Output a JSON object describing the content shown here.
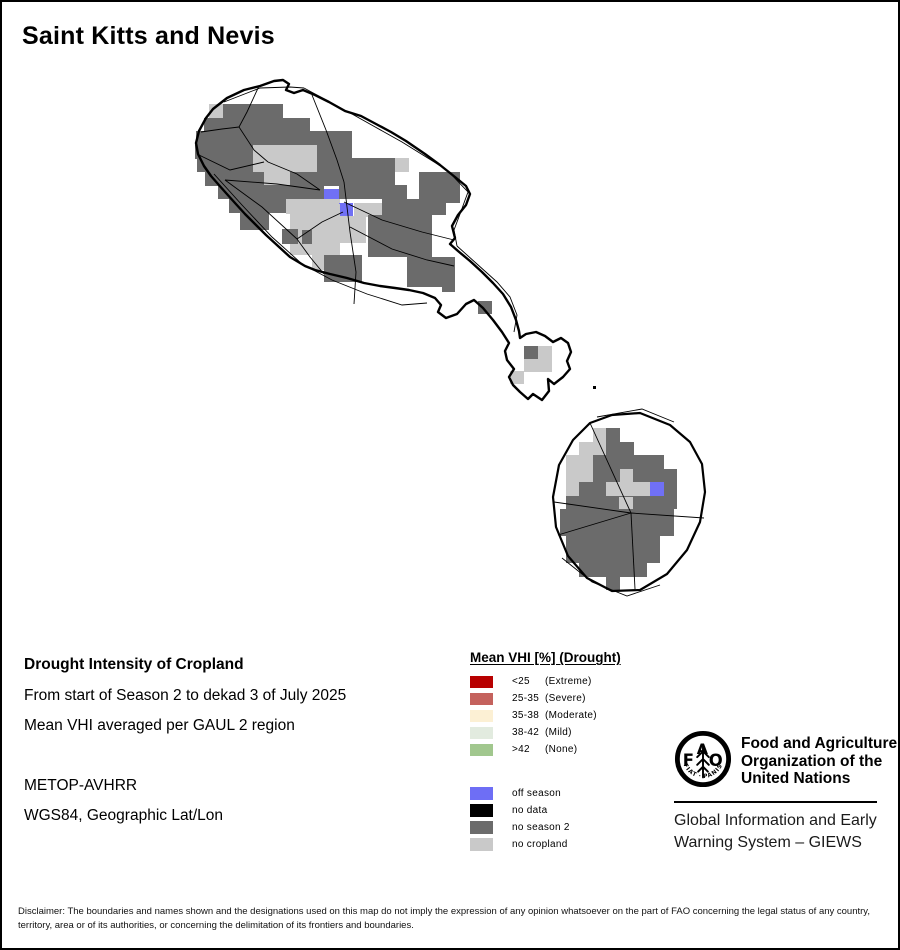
{
  "title": "Saint Kitts and Nevis",
  "info": {
    "heading": "Drought Intensity of Cropland",
    "period_line": "From start of Season 2 to dekad 3 of July 2025",
    "method_line": "Mean VHI averaged per GAUL 2 region",
    "sensor_line": "METOP-AVHRR",
    "projection_line": "WGS84, Geographic Lat/Lon"
  },
  "legend": {
    "title": "Mean VHI [%] (Drought)",
    "drought_classes": [
      {
        "range": "<25",
        "label": "(Extreme)",
        "color": "#B80000"
      },
      {
        "range": "25-35",
        "label": "(Severe)",
        "color": "#C4625D"
      },
      {
        "range": "35-38",
        "label": "(Moderate)",
        "color": "#FCF0D4"
      },
      {
        "range": "38-42",
        "label": "(Mild)",
        "color": "#E2EBDF"
      },
      {
        "range": ">42",
        "label": "(None)",
        "color": "#A1C78E"
      }
    ],
    "season_classes": [
      {
        "label": "off season",
        "color": "#6E6EF5"
      },
      {
        "label": "no data",
        "color": "#000000"
      },
      {
        "label": "no season 2",
        "color": "#6B6B6B"
      },
      {
        "label": "no cropland",
        "color": "#C9C9C9"
      }
    ]
  },
  "fao": {
    "logo_letters": "FAO",
    "logo_motto": "FIAT · PANIS",
    "org_lines": [
      "Food and Agriculture",
      "Organization of the",
      "United Nations"
    ],
    "giews_lines": [
      "Global Information and Early",
      "Warning System – GIEWS"
    ]
  },
  "disclaimer": "Disclaimer: The boundaries and names shown and the designations used on this map do not imply the expression of any opinion whatsoever on the part of FAO concerning the legal status of any country, territory, area or of its authorities, or concerning the delimitation of its frontiers and boundaries.",
  "map": {
    "colors": {
      "d": "#6B6B6B",
      "l": "#C9C9C9",
      "b": "#7070F5",
      "k": "#000000"
    },
    "color_meaning": {
      "d": "no season 2",
      "l": "no cropland",
      "b": "off season",
      "k": "no data"
    },
    "cells": [
      [
        "l",
        207,
        102,
        14,
        14
      ],
      [
        "d",
        221,
        102,
        60,
        14
      ],
      [
        "d",
        202,
        116,
        106,
        14
      ],
      [
        "d",
        194,
        129,
        156,
        14
      ],
      [
        "d",
        193,
        143,
        58,
        14
      ],
      [
        "l",
        251,
        143,
        64,
        14
      ],
      [
        "d",
        315,
        143,
        35,
        14
      ],
      [
        "d",
        195,
        156,
        56,
        14
      ],
      [
        "l",
        251,
        156,
        64,
        14
      ],
      [
        "d",
        315,
        156,
        78,
        14
      ],
      [
        "l",
        393,
        156,
        14,
        14
      ],
      [
        "d",
        203,
        170,
        59,
        14
      ],
      [
        "l",
        262,
        170,
        26,
        14
      ],
      [
        "d",
        288,
        170,
        105,
        14
      ],
      [
        "d",
        417,
        170,
        41,
        14
      ],
      [
        "d",
        216,
        183,
        106,
        14
      ],
      [
        "d",
        337,
        183,
        68,
        14
      ],
      [
        "d",
        417,
        183,
        41,
        18
      ],
      [
        "b",
        322,
        187,
        15,
        14
      ],
      [
        "d",
        227,
        197,
        57,
        14
      ],
      [
        "l",
        284,
        197,
        54,
        15
      ],
      [
        "l",
        352,
        201,
        28,
        14
      ],
      [
        "d",
        380,
        197,
        64,
        16
      ],
      [
        "b",
        337,
        201,
        14,
        13
      ],
      [
        "d",
        238,
        203,
        29,
        25
      ],
      [
        "l",
        288,
        202,
        50,
        51
      ],
      [
        "l",
        338,
        214,
        26,
        27
      ],
      [
        "d",
        366,
        213,
        64,
        42
      ],
      [
        "d",
        280,
        227,
        16,
        15
      ],
      [
        "d",
        300,
        228,
        10,
        14
      ],
      [
        "l",
        310,
        247,
        28,
        21
      ],
      [
        "d",
        322,
        253,
        38,
        27
      ],
      [
        "d",
        405,
        255,
        48,
        30
      ],
      [
        "d",
        440,
        277,
        13,
        13
      ],
      [
        "d",
        476,
        299,
        14,
        13
      ],
      [
        "d",
        522,
        344,
        14,
        13
      ],
      [
        "l",
        536,
        344,
        14,
        26
      ],
      [
        "l",
        522,
        357,
        14,
        13
      ],
      [
        "l",
        508,
        369,
        14,
        13
      ],
      [
        "k",
        591,
        384,
        3,
        3
      ],
      [
        "l",
        591,
        426,
        13,
        14
      ],
      [
        "d",
        604,
        426,
        14,
        14
      ],
      [
        "l",
        577,
        440,
        27,
        13
      ],
      [
        "d",
        604,
        440,
        28,
        13
      ],
      [
        "l",
        564,
        453,
        27,
        14
      ],
      [
        "d",
        591,
        453,
        71,
        14
      ],
      [
        "l",
        564,
        467,
        27,
        13
      ],
      [
        "d",
        591,
        467,
        27,
        13
      ],
      [
        "l",
        618,
        467,
        13,
        13
      ],
      [
        "d",
        631,
        467,
        44,
        13
      ],
      [
        "l",
        564,
        480,
        13,
        14
      ],
      [
        "d",
        577,
        480,
        27,
        14
      ],
      [
        "l",
        604,
        480,
        44,
        14
      ],
      [
        "b",
        648,
        480,
        14,
        14
      ],
      [
        "d",
        662,
        480,
        13,
        14
      ],
      [
        "d",
        564,
        494,
        111,
        13
      ],
      [
        "l",
        617,
        495,
        14,
        13
      ],
      [
        "d",
        558,
        507,
        114,
        14
      ],
      [
        "d",
        558,
        521,
        114,
        13
      ],
      [
        "d",
        564,
        534,
        94,
        14
      ],
      [
        "d",
        564,
        548,
        94,
        13
      ],
      [
        "d",
        577,
        561,
        68,
        14
      ],
      [
        "d",
        604,
        575,
        14,
        13
      ]
    ],
    "coastlines": [
      {
        "name": "saint-kitts-coast",
        "width": 2.4,
        "closed": true,
        "points": [
          [
            211,
            107
          ],
          [
            225,
            96
          ],
          [
            242,
            88
          ],
          [
            258,
            84
          ],
          [
            272,
            79
          ],
          [
            281,
            78
          ],
          [
            287,
            82
          ],
          [
            284,
            88
          ],
          [
            292,
            91
          ],
          [
            301,
            88
          ],
          [
            313,
            93
          ],
          [
            327,
            100
          ],
          [
            343,
            109
          ],
          [
            359,
            114
          ],
          [
            374,
            122
          ],
          [
            389,
            130
          ],
          [
            404,
            139
          ],
          [
            423,
            152
          ],
          [
            438,
            163
          ],
          [
            453,
            175
          ],
          [
            464,
            184
          ],
          [
            468,
            192
          ],
          [
            464,
            203
          ],
          [
            456,
            213
          ],
          [
            450,
            224
          ],
          [
            453,
            236
          ],
          [
            448,
            242
          ],
          [
            456,
            249
          ],
          [
            468,
            259
          ],
          [
            480,
            270
          ],
          [
            491,
            281
          ],
          [
            501,
            292
          ],
          [
            509,
            305
          ],
          [
            514,
            318
          ],
          [
            517,
            329
          ],
          [
            518,
            336
          ],
          [
            524,
            332
          ],
          [
            534,
            330
          ],
          [
            543,
            334
          ],
          [
            551,
            340
          ],
          [
            559,
            336
          ],
          [
            566,
            341
          ],
          [
            569,
            350
          ],
          [
            565,
            359
          ],
          [
            568,
            367
          ],
          [
            561,
            375
          ],
          [
            552,
            382
          ],
          [
            546,
            377
          ],
          [
            547,
            389
          ],
          [
            540,
            398
          ],
          [
            531,
            392
          ],
          [
            526,
            397
          ],
          [
            518,
            390
          ],
          [
            511,
            383
          ],
          [
            507,
            375
          ],
          [
            512,
            367
          ],
          [
            505,
            358
          ],
          [
            503,
            349
          ],
          [
            507,
            341
          ],
          [
            500,
            330
          ],
          [
            491,
            318
          ],
          [
            481,
            306
          ],
          [
            472,
            298
          ],
          [
            464,
            302
          ],
          [
            455,
            312
          ],
          [
            444,
            316
          ],
          [
            436,
            310
          ],
          [
            439,
            303
          ],
          [
            433,
            296
          ],
          [
            421,
            291
          ],
          [
            407,
            288
          ],
          [
            393,
            286
          ],
          [
            378,
            284
          ],
          [
            362,
            281
          ],
          [
            345,
            276
          ],
          [
            328,
            272
          ],
          [
            313,
            268
          ],
          [
            303,
            264
          ],
          [
            288,
            255
          ],
          [
            276,
            244
          ],
          [
            264,
            233
          ],
          [
            253,
            222
          ],
          [
            243,
            212
          ],
          [
            233,
            201
          ],
          [
            224,
            191
          ],
          [
            216,
            182
          ],
          [
            209,
            174
          ],
          [
            202,
            164
          ],
          [
            196,
            152
          ],
          [
            194,
            141
          ],
          [
            197,
            129
          ],
          [
            204,
            116
          ]
        ]
      },
      {
        "name": "nevis-coast",
        "width": 2.2,
        "closed": true,
        "points": [
          [
            588,
            421
          ],
          [
            610,
            413
          ],
          [
            638,
            411
          ],
          [
            668,
            423
          ],
          [
            688,
            440
          ],
          [
            700,
            462
          ],
          [
            703,
            490
          ],
          [
            698,
            520
          ],
          [
            685,
            548
          ],
          [
            665,
            572
          ],
          [
            638,
            588
          ],
          [
            610,
            589
          ],
          [
            585,
            576
          ],
          [
            566,
            554
          ],
          [
            554,
            525
          ],
          [
            551,
            495
          ],
          [
            557,
            463
          ],
          [
            571,
            438
          ]
        ]
      }
    ],
    "boundaries": [
      [
        [
          257,
          84
        ],
        [
          245,
          110
        ],
        [
          237,
          125
        ],
        [
          252,
          148
        ],
        [
          266,
          160
        ]
      ],
      [
        [
          199,
          130
        ],
        [
          220,
          127
        ],
        [
          237,
          125
        ]
      ],
      [
        [
          197,
          153
        ],
        [
          228,
          168
        ],
        [
          262,
          160
        ]
      ],
      [
        [
          266,
          160
        ],
        [
          295,
          172
        ],
        [
          318,
          188
        ]
      ],
      [
        [
          318,
          188
        ],
        [
          275,
          182
        ],
        [
          223,
          178
        ]
      ],
      [
        [
          223,
          178
        ],
        [
          260,
          205
        ],
        [
          295,
          237
        ]
      ],
      [
        [
          295,
          237
        ],
        [
          320,
          220
        ],
        [
          341,
          210
        ]
      ],
      [
        [
          295,
          237
        ],
        [
          308,
          255
        ],
        [
          322,
          272
        ]
      ],
      [
        [
          342,
          180
        ],
        [
          348,
          230
        ],
        [
          354,
          270
        ],
        [
          352,
          302
        ]
      ],
      [
        [
          310,
          93
        ],
        [
          324,
          128
        ],
        [
          335,
          158
        ],
        [
          342,
          180
        ]
      ],
      [
        [
          342,
          200
        ],
        [
          380,
          218
        ],
        [
          420,
          230
        ],
        [
          452,
          238
        ]
      ],
      [
        [
          348,
          225
        ],
        [
          390,
          247
        ],
        [
          425,
          258
        ],
        [
          452,
          264
        ]
      ],
      [
        [
          302,
          86
        ],
        [
          350,
          112
        ],
        [
          400,
          140
        ],
        [
          445,
          168
        ],
        [
          466,
          190
        ],
        [
          458,
          212
        ],
        [
          452,
          228
        ],
        [
          455,
          244
        ]
      ],
      [
        [
          212,
          172
        ],
        [
          240,
          203
        ],
        [
          270,
          235
        ],
        [
          300,
          262
        ],
        [
          330,
          278
        ],
        [
          365,
          292
        ],
        [
          400,
          303
        ],
        [
          425,
          301
        ]
      ],
      [
        [
          222,
          100
        ],
        [
          258,
          86
        ],
        [
          288,
          85
        ],
        [
          302,
          86
        ]
      ],
      [
        [
          455,
          244
        ],
        [
          475,
          262
        ],
        [
          495,
          280
        ],
        [
          508,
          295
        ],
        [
          515,
          313
        ],
        [
          512,
          330
        ]
      ],
      [
        [
          629,
          511
        ],
        [
          588,
          421
        ]
      ],
      [
        [
          629,
          511
        ],
        [
          552,
          500
        ]
      ],
      [
        [
          629,
          511
        ],
        [
          556,
          533
        ]
      ],
      [
        [
          629,
          511
        ],
        [
          633,
          587
        ]
      ],
      [
        [
          629,
          511
        ],
        [
          702,
          516
        ]
      ],
      [
        [
          595,
          415
        ],
        [
          640,
          407
        ],
        [
          672,
          420
        ]
      ],
      [
        [
          560,
          556
        ],
        [
          590,
          580
        ],
        [
          625,
          594
        ],
        [
          658,
          583
        ]
      ]
    ]
  }
}
